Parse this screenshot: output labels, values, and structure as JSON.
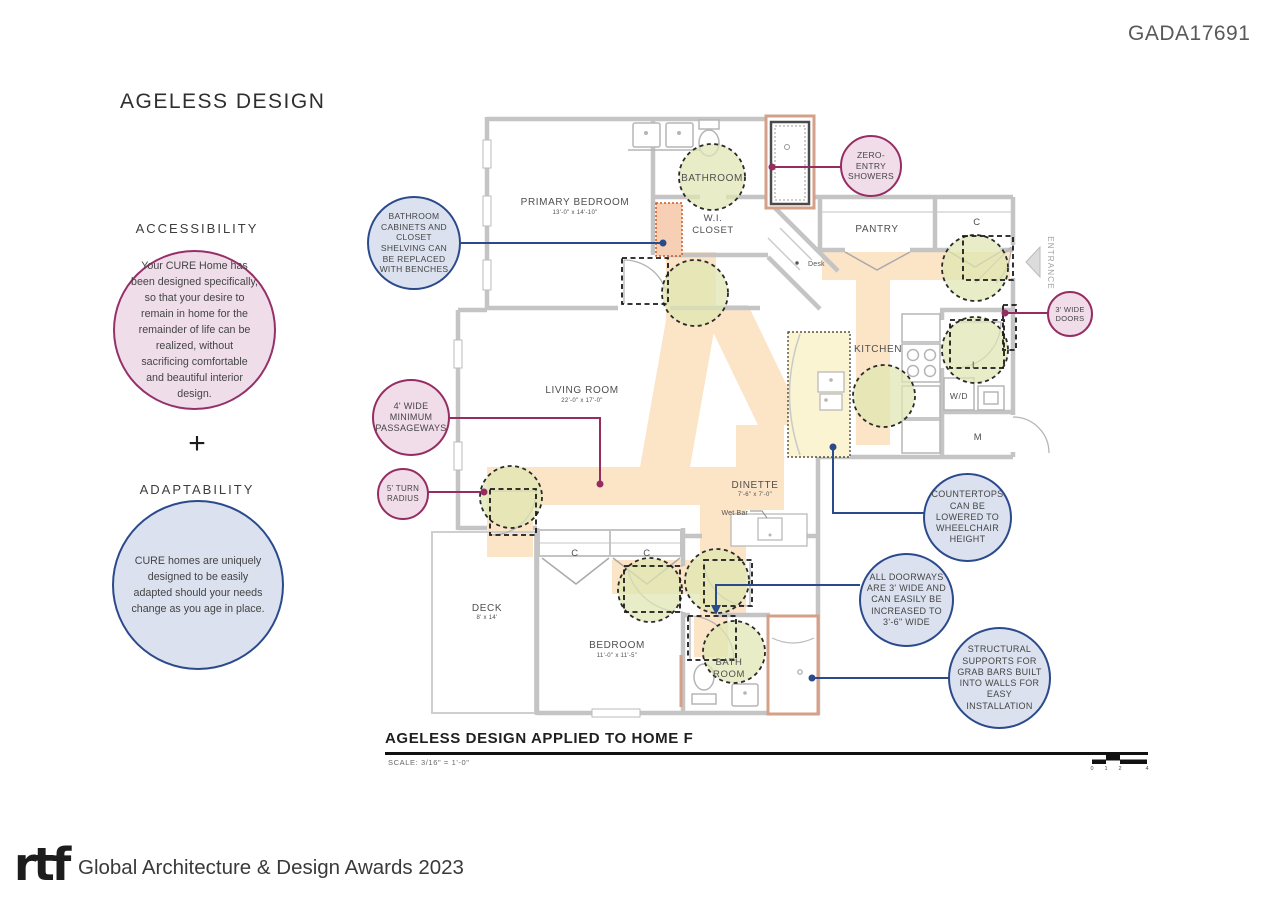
{
  "header": {
    "code": "GADA17691"
  },
  "board": {
    "title": "AGELESS DESIGN"
  },
  "concepts": {
    "accessibility": {
      "heading": "ACCESSIBILITY",
      "body": "Your CURE Home has been designed specifically, so that your desire to remain in home for the remainder of life can be realized, without sacrificing comfortable and beautiful interior design."
    },
    "plus": "+",
    "adaptability": {
      "heading": "ADAPTABILITY",
      "body": "CURE homes are uniquely designed to be easily adapted should your needs change as you age in place."
    }
  },
  "plan": {
    "rooms": {
      "primary_bedroom": {
        "name": "PRIMARY BEDROOM",
        "dims": "13'-0\" x 14'-10\""
      },
      "bathroom": {
        "name": "BATHROOM"
      },
      "wi_closet": {
        "line1": "W.I.",
        "line2": "CLOSET"
      },
      "pantry": {
        "name": "PANTRY"
      },
      "living_room": {
        "name": "LIVING ROOM",
        "dims": "22'-0\" x 17'-0\""
      },
      "kitchen": {
        "name": "KITCHEN"
      },
      "dinette": {
        "name": "DINETTE",
        "dims": "7'-6\" x 7'-0\""
      },
      "deck": {
        "name": "DECK",
        "dims": "8' x 14'"
      },
      "bedroom": {
        "name": "BEDROOM",
        "dims": "11'-0\" x 11'-5\""
      },
      "bath_room": {
        "line1": "BATH",
        "line2": "ROOM"
      }
    },
    "labels": {
      "closet": "C",
      "laundry": "L",
      "washer_dryer": "W/D",
      "mudroom": "M",
      "entrance": "ENTRANCE",
      "desk": "Desk",
      "wet_bar": "Wet Bar"
    }
  },
  "annotations": {
    "zero_entry_showers": "ZERO-ENTRY SHOWERS",
    "wide_doors": "3' WIDE DOORS",
    "bathroom_benches": "BATHROOM CABINETS AND CLOSET SHELVING CAN BE REPLACED WITH BENCHES",
    "passageways": "4' WIDE MINIMUM PASSAGEWAYS",
    "turn_radius": "5' TURN RADIUS",
    "countertops": "COUNTERTOPS CAN BE LOWERED TO WHEELCHAIR HEIGHT",
    "doorways": "ALL DOORWAYS ARE 3' WIDE AND CAN EASILY BE INCREASED TO 3'-6\" WIDE",
    "grab_bars": "STRUCTURAL SUPPORTS FOR GRAB BARS BUILT INTO WALLS FOR EASY INSTALLATION"
  },
  "title_block": {
    "title": "AGELESS DESIGN APPLIED TO HOME F",
    "scale": "SCALE: 3/16\" = 1'-0\"",
    "scale_ticks": [
      "0",
      "1",
      "2",
      "4"
    ]
  },
  "footer": {
    "logo": "rtf",
    "text": "Global Architecture & Design Awards 2023"
  },
  "colors": {
    "magenta": "#952d63",
    "pink_fill": "#f1dce9",
    "navy": "#2b4a8c",
    "blue_fill": "#dbe1ee",
    "peach_path": "#fce4c6",
    "clearance_green": "#dfe6b2",
    "wall_gray": "#c4c4c4",
    "salmon_trim": "#d4a088"
  }
}
